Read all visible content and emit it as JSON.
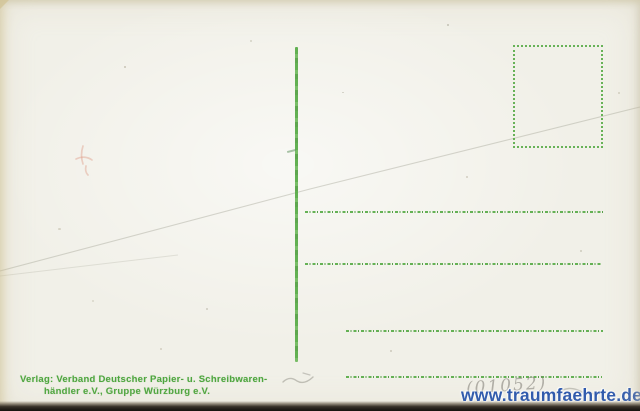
{
  "card": {
    "type": "postcard-back-scan",
    "imprint": {
      "line1": "Verlag: Verband Deutscher Papier- u. Schreibwaren-",
      "line2": "händler e.V., Gruppe Würzburg e.V."
    },
    "pencil_note": "(01052)",
    "watermark": "www.traumfaehrte.de",
    "stamp_box": {
      "label": ""
    },
    "address_line_count": 4
  },
  "colors": {
    "card_bg": "#f1f0e8",
    "print_green": "#4ea63f",
    "line_green": "#55aa44",
    "watermark_blue": "#2a57ae",
    "pencil_gray": "#84827a",
    "crease_gray": "#a9a89c",
    "smudge_red": "#dd9884",
    "edge_dark": "#241f1a"
  }
}
